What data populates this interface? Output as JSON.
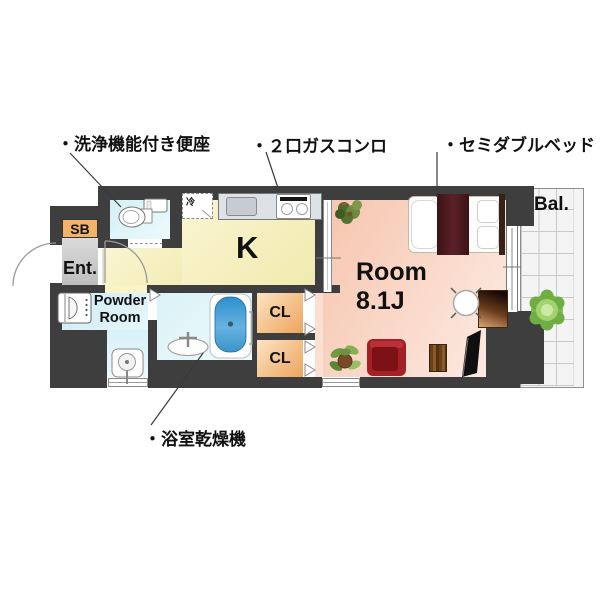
{
  "callouts": {
    "washlet": "・洗浄機能付き便座",
    "gas_stove": "・２口ガスコンロ",
    "semi_double_bed": "・セミダブルベッド",
    "bath_dryer": "・浴室乾燥機"
  },
  "rooms": {
    "kitchen": "K",
    "room_name": "Room",
    "room_size": "8.1J",
    "closet_upper": "CL",
    "closet_lower": "CL",
    "shoe_box": "SB",
    "entrance": "Ent.",
    "powder_line1": "Powder",
    "powder_line2": "Room",
    "balcony": "Bal.",
    "refrigerator": "冷"
  },
  "colors": {
    "wall": "#3e3e3e",
    "kitchen_floor": "#f7f1c0",
    "room_floor": "#f8cfba",
    "wet_area_floor": "#dbf2f6",
    "powder_floor": "#cfeaf4",
    "entrance_floor": "#c8c8c8",
    "shoe_box_fill": "#f3b26a",
    "closet_fill": "#f0ad62",
    "balcony_fill": "#f4f4f4",
    "bed_accent": "#4e1b21",
    "sofa_red": "#a32026",
    "bathtub_blue": "#2f8fd0",
    "plant_green": "#7cb94e"
  },
  "icons": {
    "toilet": "toilet-icon",
    "washing_machine": "washing-machine-icon",
    "sink": "sink-icon",
    "bathtub": "bathtub-icon",
    "shower_stand": "shower-stand-icon",
    "gas_stove": "stove-icon",
    "kitchen_sink": "kitchen-sink-icon",
    "bed": "bed-icon",
    "sofa": "sofa-icon",
    "tv": "tv-icon",
    "desk": "desk-icon",
    "chair": "chair-icon",
    "side_table": "table-icon",
    "plants": "plant-icon"
  }
}
